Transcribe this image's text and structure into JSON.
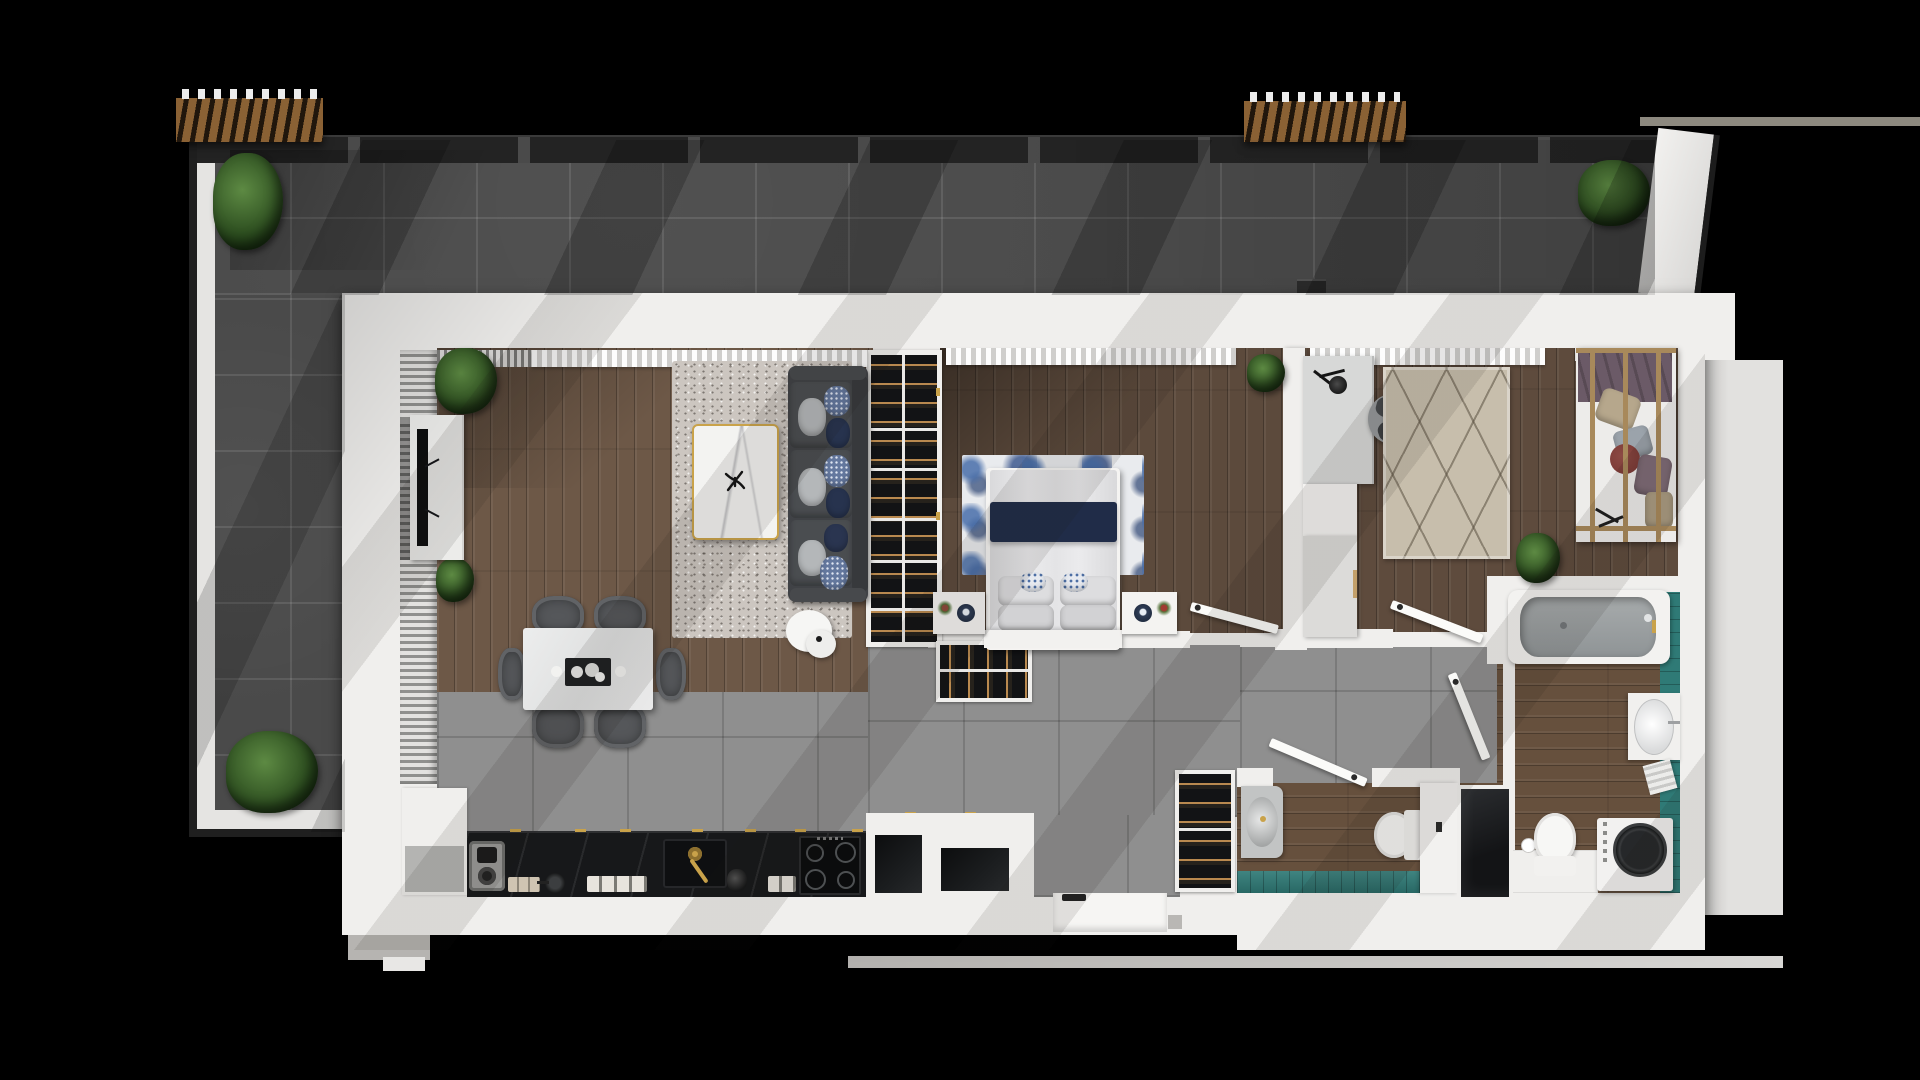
{
  "scene": {
    "type": "3d-rendered-apartment-floor-plan-top-view",
    "background": "black",
    "text_visible_in_image": "none"
  },
  "rooms": {
    "terrace": "Terrace",
    "living_room": "Living room",
    "dining_area": "Dining area",
    "kitchen": "Kitchen",
    "hallway": "Hallway",
    "entrance": "Entrance",
    "bedroom_1": "Bedroom 1",
    "bedroom_2": "Bedroom 2",
    "bathroom": "Bathroom",
    "wc": "Shower room"
  },
  "furniture": {
    "terrace": [
      "pergola",
      "pergola",
      "potted-plant",
      "potted-plant",
      "potted-plant",
      "railing"
    ],
    "living_room": [
      "tv-unit",
      "tv",
      "sofa-3-seat",
      "coffee-table-marble",
      "side-table",
      "area-rug",
      "plants",
      "curtains"
    ],
    "dining_area": [
      "dining-table-marble",
      "chair",
      "chair",
      "chair",
      "chair",
      "chair",
      "chair",
      "serving-tray"
    ],
    "kitchen": [
      "counter-black-marble",
      "coffee-machine",
      "canisters",
      "pan",
      "sink",
      "gold-faucet",
      "kettle",
      "cooktop-4-burner",
      "cabinet"
    ],
    "bedroom_1": [
      "wardrobe-open",
      "double-bed",
      "navy-runner",
      "pillows",
      "floral-rug-blue",
      "nightstand",
      "nightstand",
      "lamp",
      "lamp",
      "plant",
      "door"
    ],
    "bedroom_2": [
      "desk",
      "desk-lamp",
      "desk-chair",
      "cabinets",
      "diamond-rug-beige",
      "daybed-wood-frame",
      "cushions",
      "plant",
      "door"
    ],
    "bathroom": [
      "bathtub",
      "vanity-sink",
      "toilet",
      "washing-machine",
      "cabinet",
      "teal-tile-wall",
      "door"
    ],
    "wc": [
      "vanity-sink-gray",
      "toilet",
      "tall-cabinet",
      "shower-dark",
      "teal-tile-wall",
      "door"
    ],
    "hallway": [
      "closet-hangers",
      "closet-hangers",
      "entrance-door"
    ]
  },
  "colors": {
    "background": "#000000",
    "wall": "#f0efed",
    "wall_shadow": "#d8d6d3",
    "terrace_tile": "#4a4a4a",
    "railing": "#1f1f1f",
    "pergola_wood": "#8a6134",
    "plant_green": "#3f6b2e",
    "wood_living": "#6d5847",
    "wood_bedroom": "#5c4a3c",
    "wood_bath": "#66503d",
    "tile_gray": "#8f8f8f",
    "rug_living": "#ccc6c0",
    "rug_bedroom_blue": "#5d7fae",
    "rug_beige": "#c7beac",
    "sofa_gray": "#404246",
    "navy": "#202c48",
    "counter_black": "#17181a",
    "gold": "#c9a24a",
    "teal": "#2f7a76",
    "tub_gray": "#9aa0a2",
    "daybed_purple": "#6b5a67",
    "bordeaux": "#7c3a36",
    "exterior_slab": "#e2e1df",
    "bottom_ledge": "#b3b1ae"
  }
}
